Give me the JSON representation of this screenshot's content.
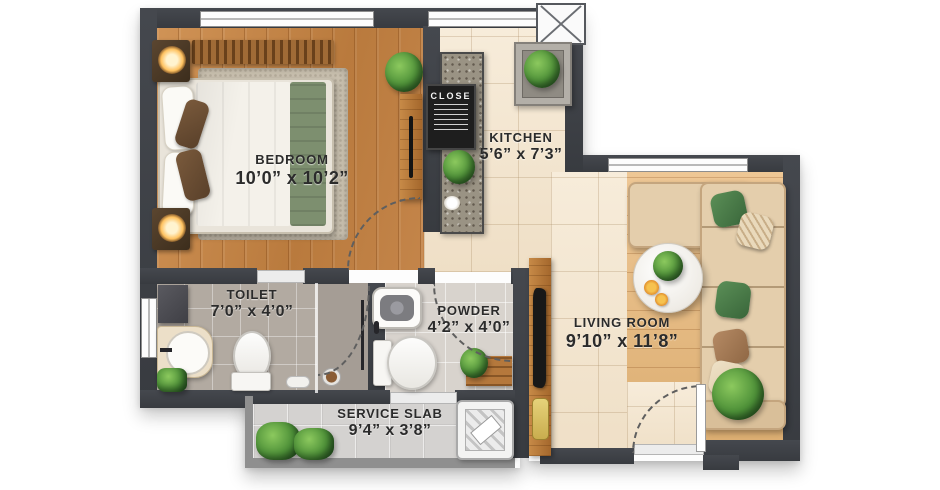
{
  "plan": {
    "rooms": {
      "bedroom": {
        "name": "BEDROOM",
        "dims": "10’0” x 10’2”"
      },
      "kitchen": {
        "name": "KITCHEN",
        "dims": "5’6” x 7’3”"
      },
      "living_room": {
        "name": "LIVING ROOM",
        "dims": "9’10” x 11’8”"
      },
      "toilet": {
        "name": "TOILET",
        "dims": "7’0” x 4’0”"
      },
      "powder": {
        "name": "POWDER",
        "dims": "4’2” x 4’0”"
      },
      "service_slab": {
        "name": "SERVICE SLAB",
        "dims": "9’4” x 3’8”"
      }
    },
    "kitchen_board": {
      "title": "CLOSE"
    },
    "colors": {
      "wall": "#3e4146",
      "wood_bedroom": "#c08048",
      "wood_living": "#e6bc85",
      "tile_cream": "#f4e7d3",
      "tile_toilet": "#b2aaa1",
      "tile_powder": "#d8d3cd",
      "accent_green": "#4e7d52",
      "sofa_beige": "#e4ceac",
      "label_text": "#2b2b2b"
    }
  }
}
